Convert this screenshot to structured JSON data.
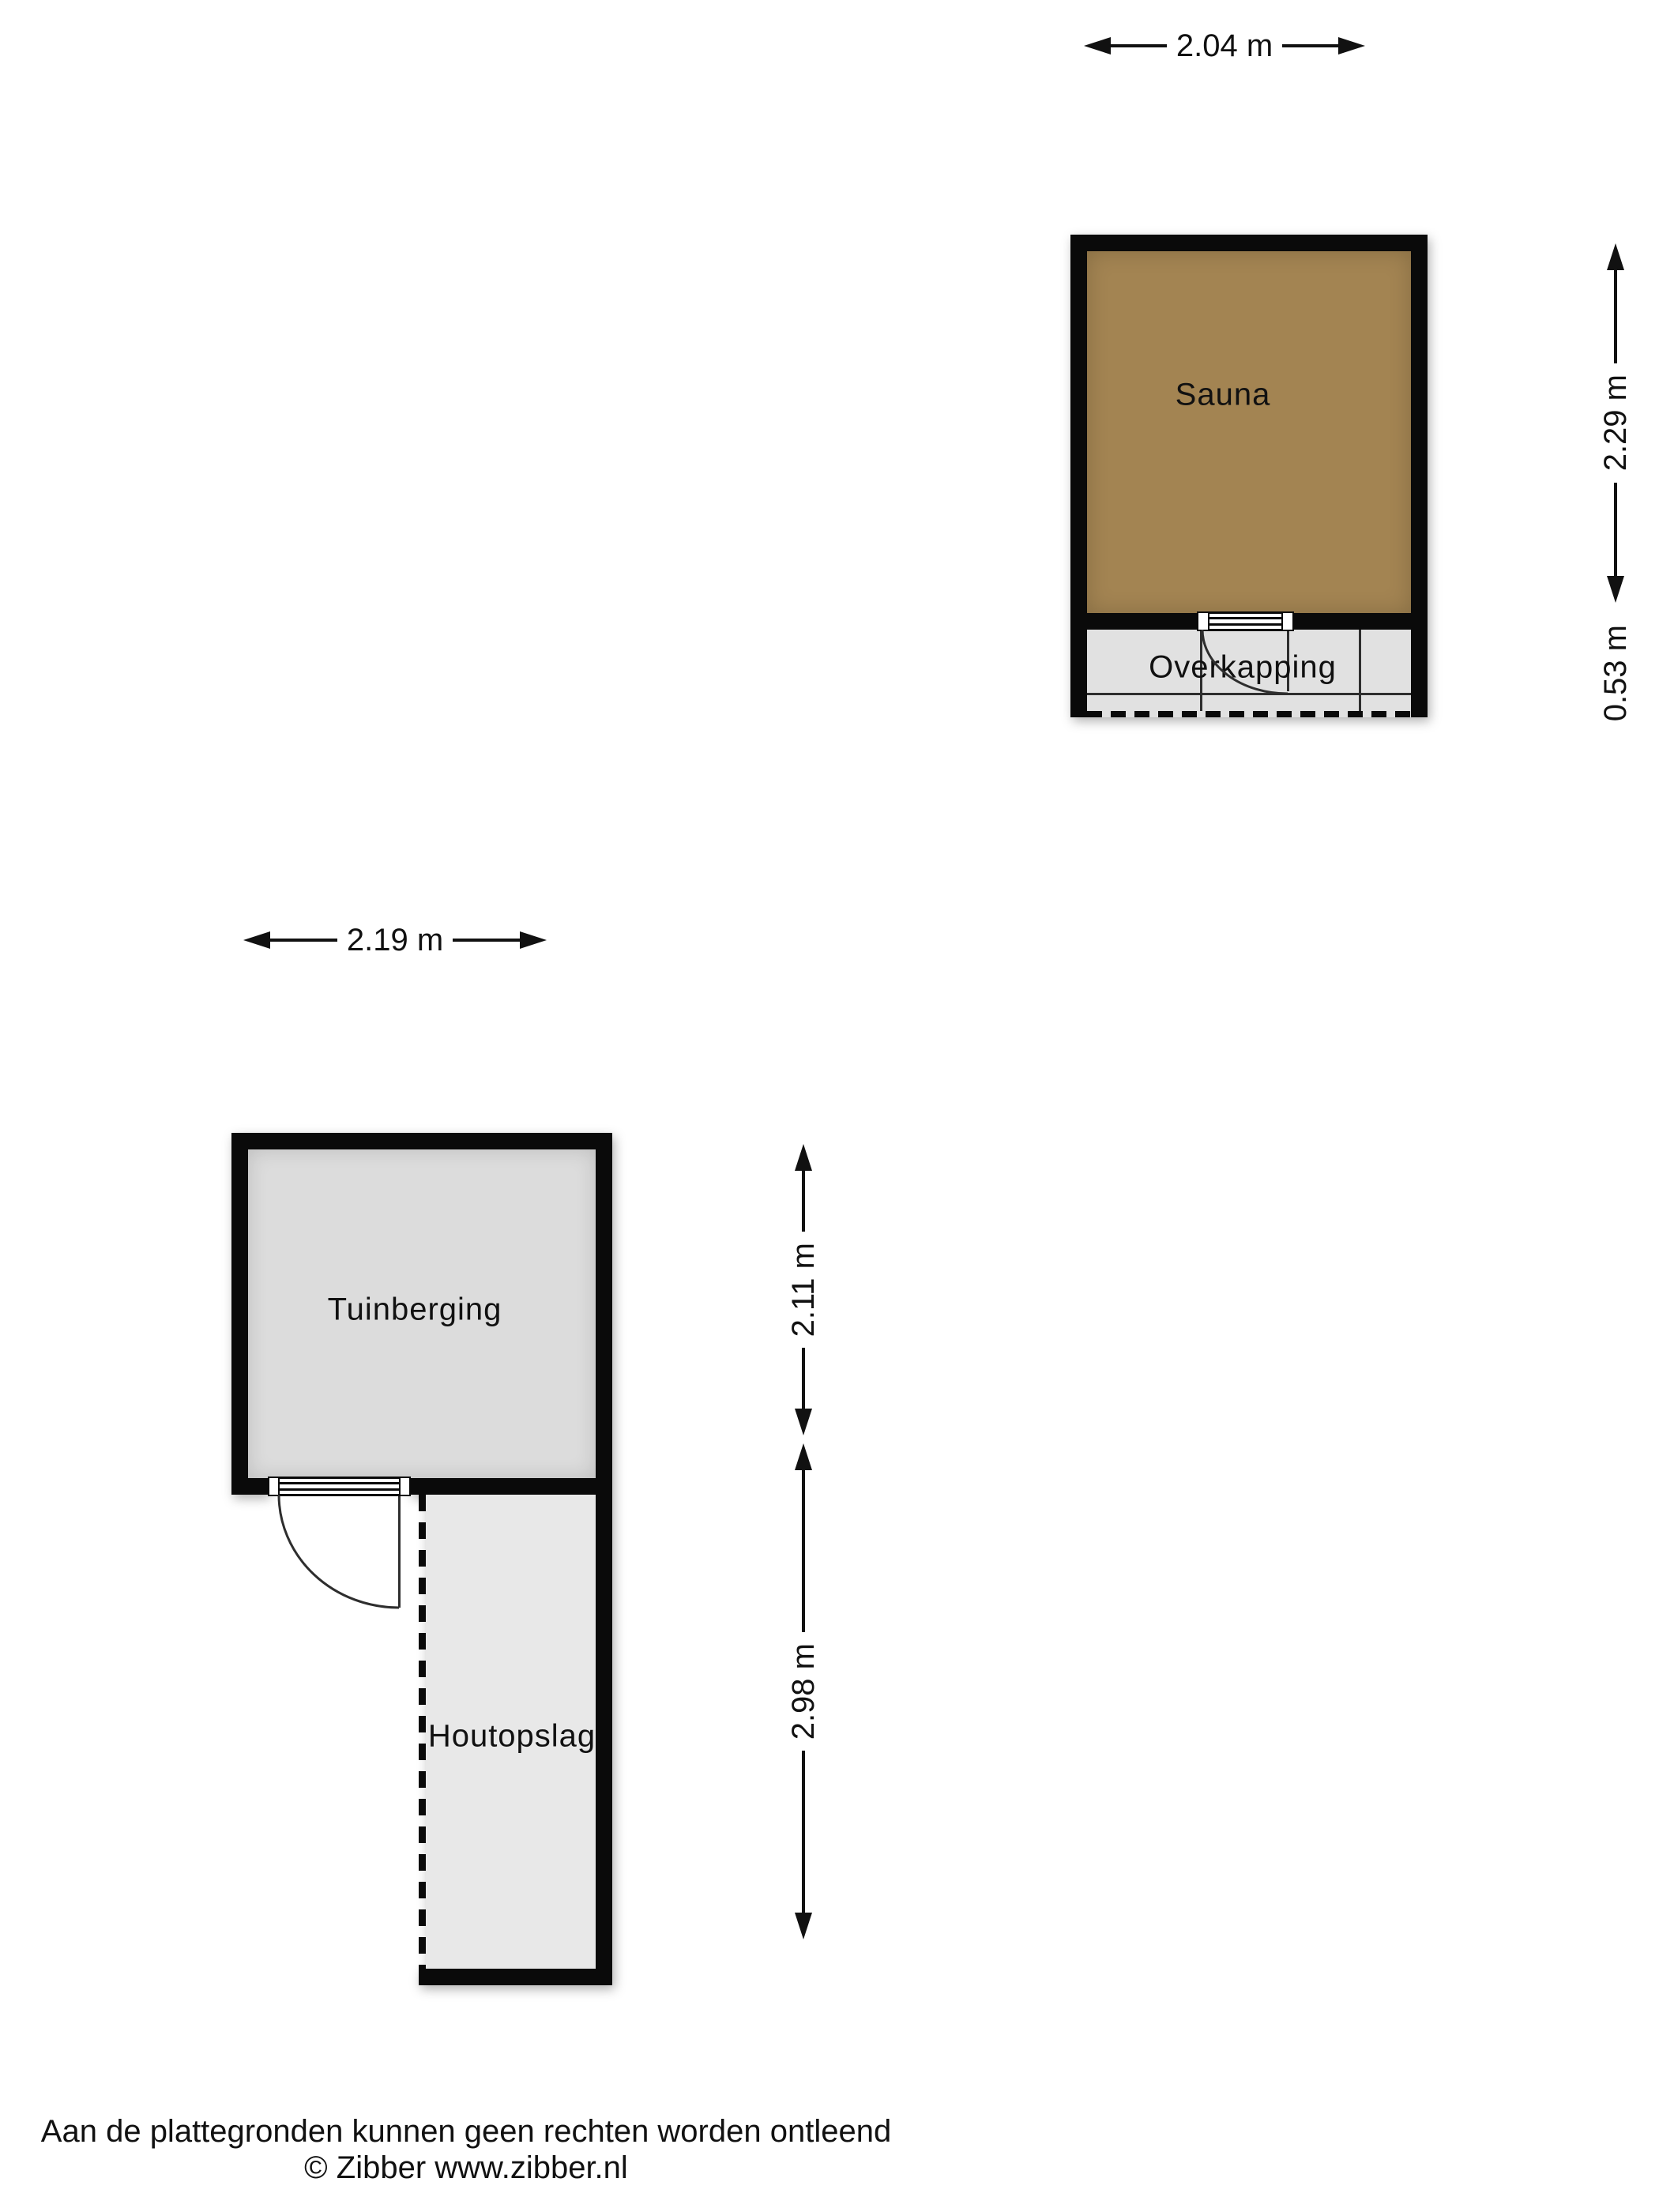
{
  "colors": {
    "wall": "#0a0a0a",
    "sauna-fill": "#a38452",
    "room-fill": "#dcdcdc",
    "canopy-fill": "#e1e1e1",
    "storage-fill": "#e8e8e8",
    "line": "#2e2e2e",
    "text": "#111111"
  },
  "sauna_building": {
    "room_label": "Sauna",
    "canopy_label": "Overkapping",
    "width_dim": "2.04 m",
    "room_height_dim": "2.29 m",
    "canopy_height_dim": "0.53 m"
  },
  "shed_building": {
    "room_label": "Tuinberging",
    "storage_label": "Houtopslag",
    "width_dim": "2.19 m",
    "room_height_dim": "2.11 m",
    "storage_height_dim": "2.98 m"
  },
  "footer": {
    "disclaimer": "Aan de plattegronden kunnen geen rechten worden ontleend",
    "copyright": "© Zibber www.zibber.nl"
  }
}
